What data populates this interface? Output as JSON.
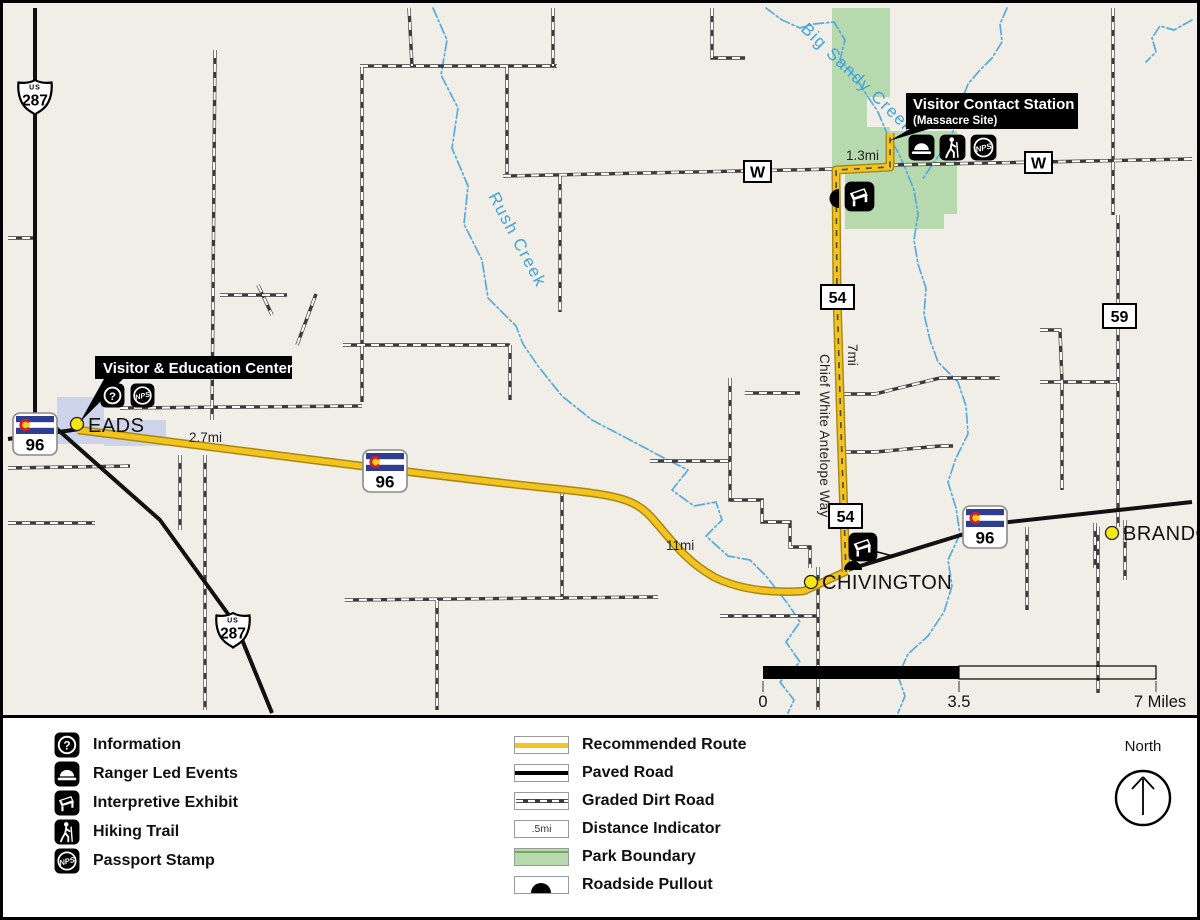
{
  "map": {
    "towns": [
      "EADS",
      "CHIVINGTON",
      "BRANDON"
    ],
    "creek_labels": [
      "Big Sandy Creek",
      "Rush Creek"
    ],
    "road_label": "Chief White Antelope Way",
    "shields": {
      "us_label": "US",
      "us287": "287",
      "co96": "96",
      "r54": "54",
      "r59": "59",
      "w": "W"
    },
    "distances": {
      "eads": "2.7mi",
      "mid": "11mi",
      "cwaw": "7mi",
      "spur": "1.3mi"
    },
    "callouts": {
      "education_center": {
        "title": "Visitor & Education Center"
      },
      "contact_station": {
        "title": "Visitor Contact Station",
        "subtitle": "(Massacre Site)"
      }
    },
    "scalebar": {
      "zero": "0",
      "half": "3.5",
      "full": "7 Miles"
    },
    "north": "North"
  },
  "legend": {
    "facilities": [
      {
        "icon": "information-icon",
        "label": "Information"
      },
      {
        "icon": "ranger-led-events-icon",
        "label": "Ranger Led Events"
      },
      {
        "icon": "interpretive-exhibit-icon",
        "label": "Interpretive Exhibit"
      },
      {
        "icon": "hiking-trail-icon",
        "label": "Hiking Trail"
      },
      {
        "icon": "passport-stamp-icon",
        "label": "Passport Stamp"
      }
    ],
    "symbols": [
      {
        "swatch": "recommended-route",
        "label": "Recommended Route"
      },
      {
        "swatch": "paved-road",
        "label": "Paved Road"
      },
      {
        "swatch": "graded-dirt-road",
        "label": "Graded Dirt Road"
      },
      {
        "swatch": "distance-indicator",
        "label": "Distance Indicator",
        "sample": ".5mi"
      },
      {
        "swatch": "park-boundary",
        "label": "Park Boundary"
      },
      {
        "swatch": "roadside-pullout",
        "label": "Roadside Pullout"
      }
    ]
  },
  "colors": {
    "map_background": "#f1eee7",
    "route_yellow": "#f2c41d",
    "route_casing": "#a88714",
    "park_green": "#b7d9ae",
    "creek_blue": "#55abe0",
    "town_dot_yellow": "#f7e714",
    "flag_blue": "#2e3d8f",
    "flag_red": "#d0202a",
    "flag_gold": "#f7d117"
  }
}
